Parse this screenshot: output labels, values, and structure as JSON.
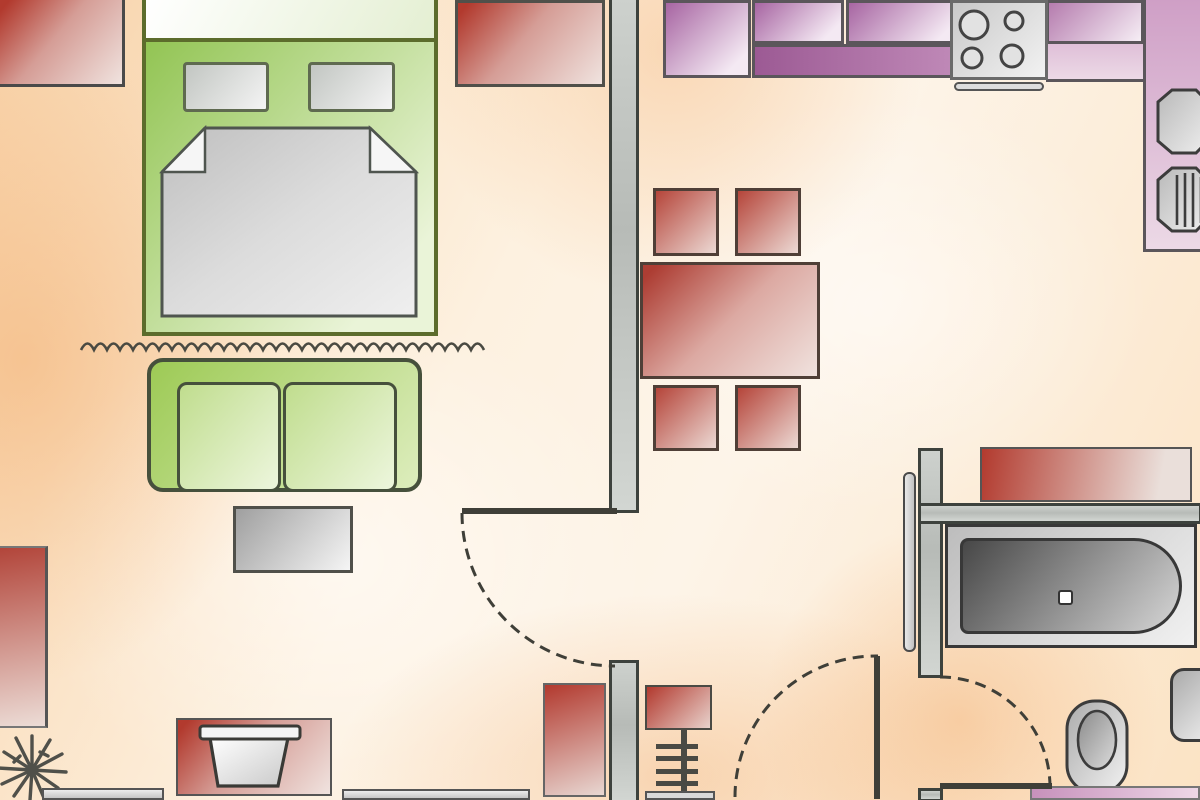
{
  "title": "apartment-floor-plan",
  "colors": {
    "red-a": "#b23a2e",
    "red-b": "#f0e3df",
    "green-a": "#8cc14a",
    "green-b": "#eaf4d8",
    "gray-a": "#9f9f9f",
    "gray-b": "#f5f5f5",
    "purple-a": "#a765a2",
    "purple-b": "#f4e9f3",
    "pink-a": "#cf9fc6",
    "pink-b": "#ecd9e6",
    "counter-dark": "#9c5a94",
    "wall-edge": "#3d423d",
    "floor-a": "#f8d2a8",
    "floor-b": "#fdf4e8",
    "tub-a": "#474747",
    "tub-b": "#d6d6d6",
    "line": "#4a4a42"
  },
  "labels": {
    "bed": "double bed",
    "pillow": "pillow",
    "blanket": "blanket",
    "sofa": "sofa",
    "coffee_table": "coffee table",
    "dining_table": "dining table",
    "chair": "chair",
    "kitchen_cabinet": "kitchen cabinet",
    "countertop": "countertop",
    "stove": "stove with four burners",
    "kitchen_sink": "kitchen sink",
    "bathtub": "bathtub",
    "toilet": "toilet",
    "wash_basin": "wash basin",
    "bath_mat": "bath mat",
    "vanity": "vanity counter",
    "rug": "rug",
    "plant": "plant",
    "flower_pot": "flower pot",
    "radiator": "radiator shelf",
    "door": "door swing",
    "wall": "wall",
    "curtain": "curtain divider"
  },
  "rooms": [
    {
      "name": "bedroom-living-area",
      "furniture": [
        "double-bed",
        "two-pillows",
        "blanket",
        "curtain-divider",
        "sofa",
        "coffee-table",
        "plant",
        "flower-pot",
        "area-rugs"
      ]
    },
    {
      "name": "kitchen-dining-area",
      "furniture": [
        "kitchen-cabinets",
        "dark-countertop",
        "stove-4-burners",
        "double-sink",
        "dining-table",
        "four-chairs",
        "radiator-shelf",
        "rug"
      ]
    },
    {
      "name": "bathroom",
      "furniture": [
        "bathtub-with-drain",
        "bath-mat",
        "toilet",
        "wash-basin",
        "vanity-counter",
        "parked-door-leaf"
      ]
    }
  ],
  "doors": [
    {
      "name": "living-room-door",
      "swing": "quarter-arc"
    },
    {
      "name": "hall-door",
      "swing": "quarter-arc"
    },
    {
      "name": "bathroom-door",
      "swing": "quarter-arc"
    }
  ]
}
